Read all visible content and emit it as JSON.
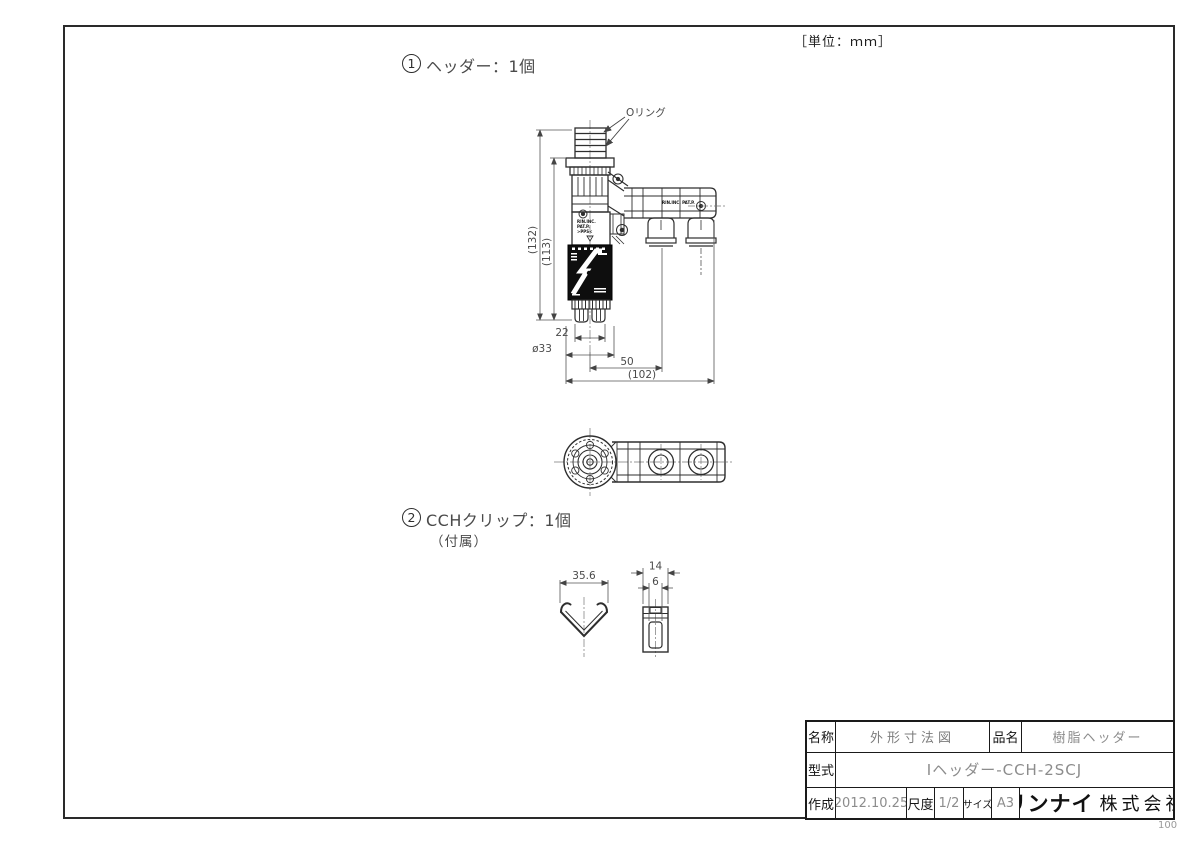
{
  "sheet": {
    "unit_label": "［単位：ｍｍ］",
    "corner_note": "100"
  },
  "item1": {
    "number": "1",
    "label": "ヘッダー：1個",
    "oring_label": "Oリング",
    "molded_line1": "RIN.INC.",
    "molded_line2": "PAT.P.",
    "molded_line3": ">PPS<",
    "molded_arm": "RIN.INC. PAT.P.",
    "dim_total_height": "(132)",
    "dim_body_height": "(113)",
    "dim_prong_width": "22",
    "dim_flange_dia": "ø33",
    "dim_port_offset": "50",
    "dim_total_width": "(102)"
  },
  "item2": {
    "number": "2",
    "label": "CCHクリップ：1個",
    "note": "（付属）",
    "dim_width": "35.6",
    "dim_depth": "14",
    "dim_slot": "6"
  },
  "title_block": {
    "name_label": "名称",
    "name_value": "外形寸法図",
    "item_label": "品名",
    "item_value": "樹脂ヘッダー",
    "model_label": "型式",
    "model_value": "Iヘッダー-CCH-2SCJ",
    "date_label": "作成",
    "date_value": "2012.10.25",
    "scale_label": "尺度",
    "scale_value": "1/2",
    "size_label": "サイズ",
    "size_value": "A3",
    "company_bold": "リンナイ",
    "company_rest": "株式会社"
  }
}
